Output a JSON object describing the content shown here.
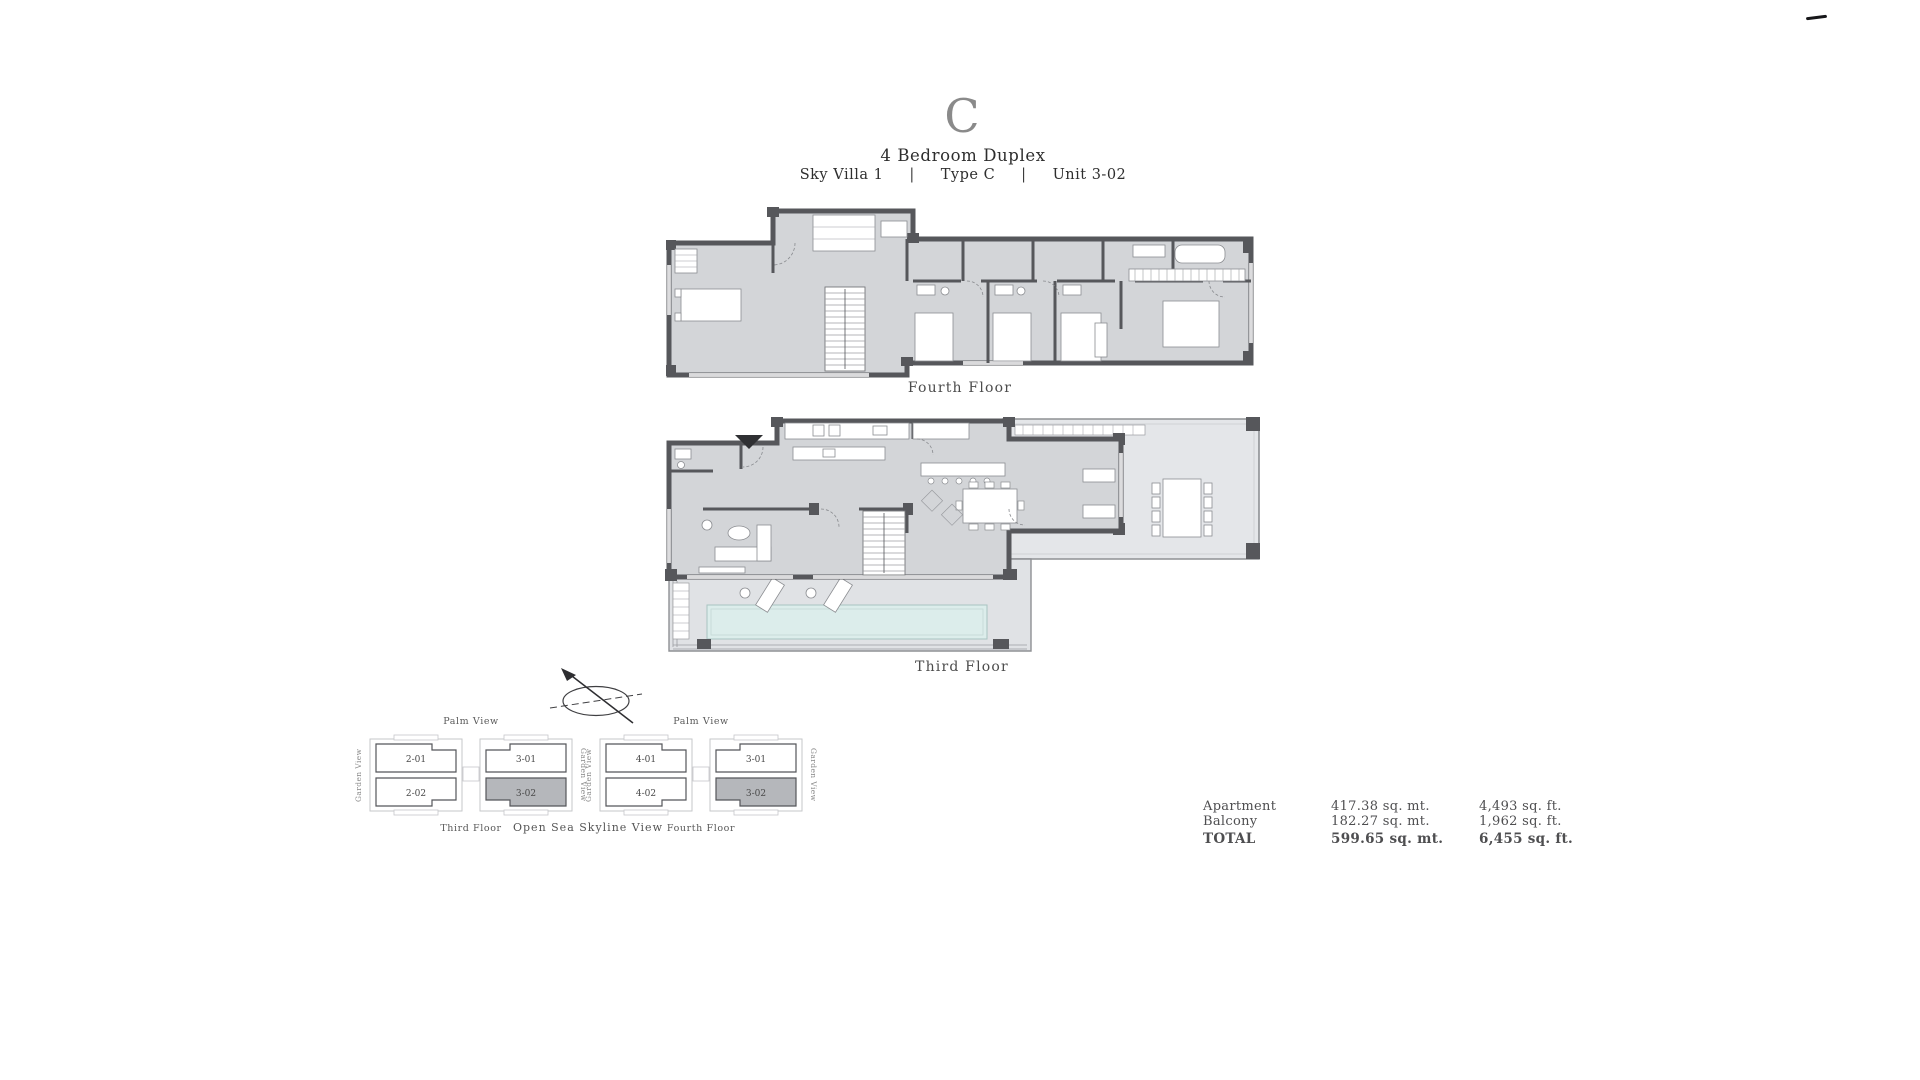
{
  "header": {
    "plan_letter": "C",
    "title": "4 Bedroom Duplex",
    "project": "Sky Villa 1",
    "type": "Type C",
    "unit": "Unit 3-02",
    "separator": "|"
  },
  "floor_plans": {
    "fourth": {
      "label": "Fourth Floor"
    },
    "third": {
      "label": "Third Floor"
    }
  },
  "key_plans": {
    "third": {
      "palm_label": "Palm View",
      "garden_left": "Garden View",
      "garden_right": "Garden View",
      "floor_label": "Third Floor",
      "units": [
        {
          "id": "2-01",
          "highlighted": false
        },
        {
          "id": "3-01",
          "highlighted": false
        },
        {
          "id": "2-02",
          "highlighted": false
        },
        {
          "id": "3-02",
          "highlighted": true
        }
      ]
    },
    "fourth": {
      "palm_label": "Palm View",
      "garden_left": "Garden View",
      "garden_right": "Garden View",
      "floor_label": "Fourth Floor",
      "units": [
        {
          "id": "4-01",
          "highlighted": false
        },
        {
          "id": "3-01",
          "highlighted": false
        },
        {
          "id": "4-02",
          "highlighted": false
        },
        {
          "id": "3-02",
          "highlighted": true
        }
      ]
    },
    "sea_label": "Open Sea Skyline View"
  },
  "area_table": {
    "rows": [
      {
        "name": "Apartment",
        "metric": "417.38 sq. mt.",
        "imperial": "4,493 sq. ft."
      },
      {
        "name": "Balcony",
        "metric": "182.27 sq. mt.",
        "imperial": "1,962 sq. ft."
      },
      {
        "name": "TOTAL",
        "metric": "599.65 sq. mt.",
        "imperial": "6,455 sq. ft."
      }
    ]
  },
  "icons": {
    "compass": "north-compass-icon",
    "entry_marker": "entry-arrow-icon"
  },
  "colors": {
    "wall": "#56575b",
    "floor": "#d3d5d8",
    "balcony_floor": "#e4e6e9",
    "terrace_floor": "#e0e2e5",
    "pool": "#dcedeb",
    "unit_highlight": "#b5b7bb",
    "title_gray": "#8a8a8a",
    "text": "#4a4a4a"
  }
}
